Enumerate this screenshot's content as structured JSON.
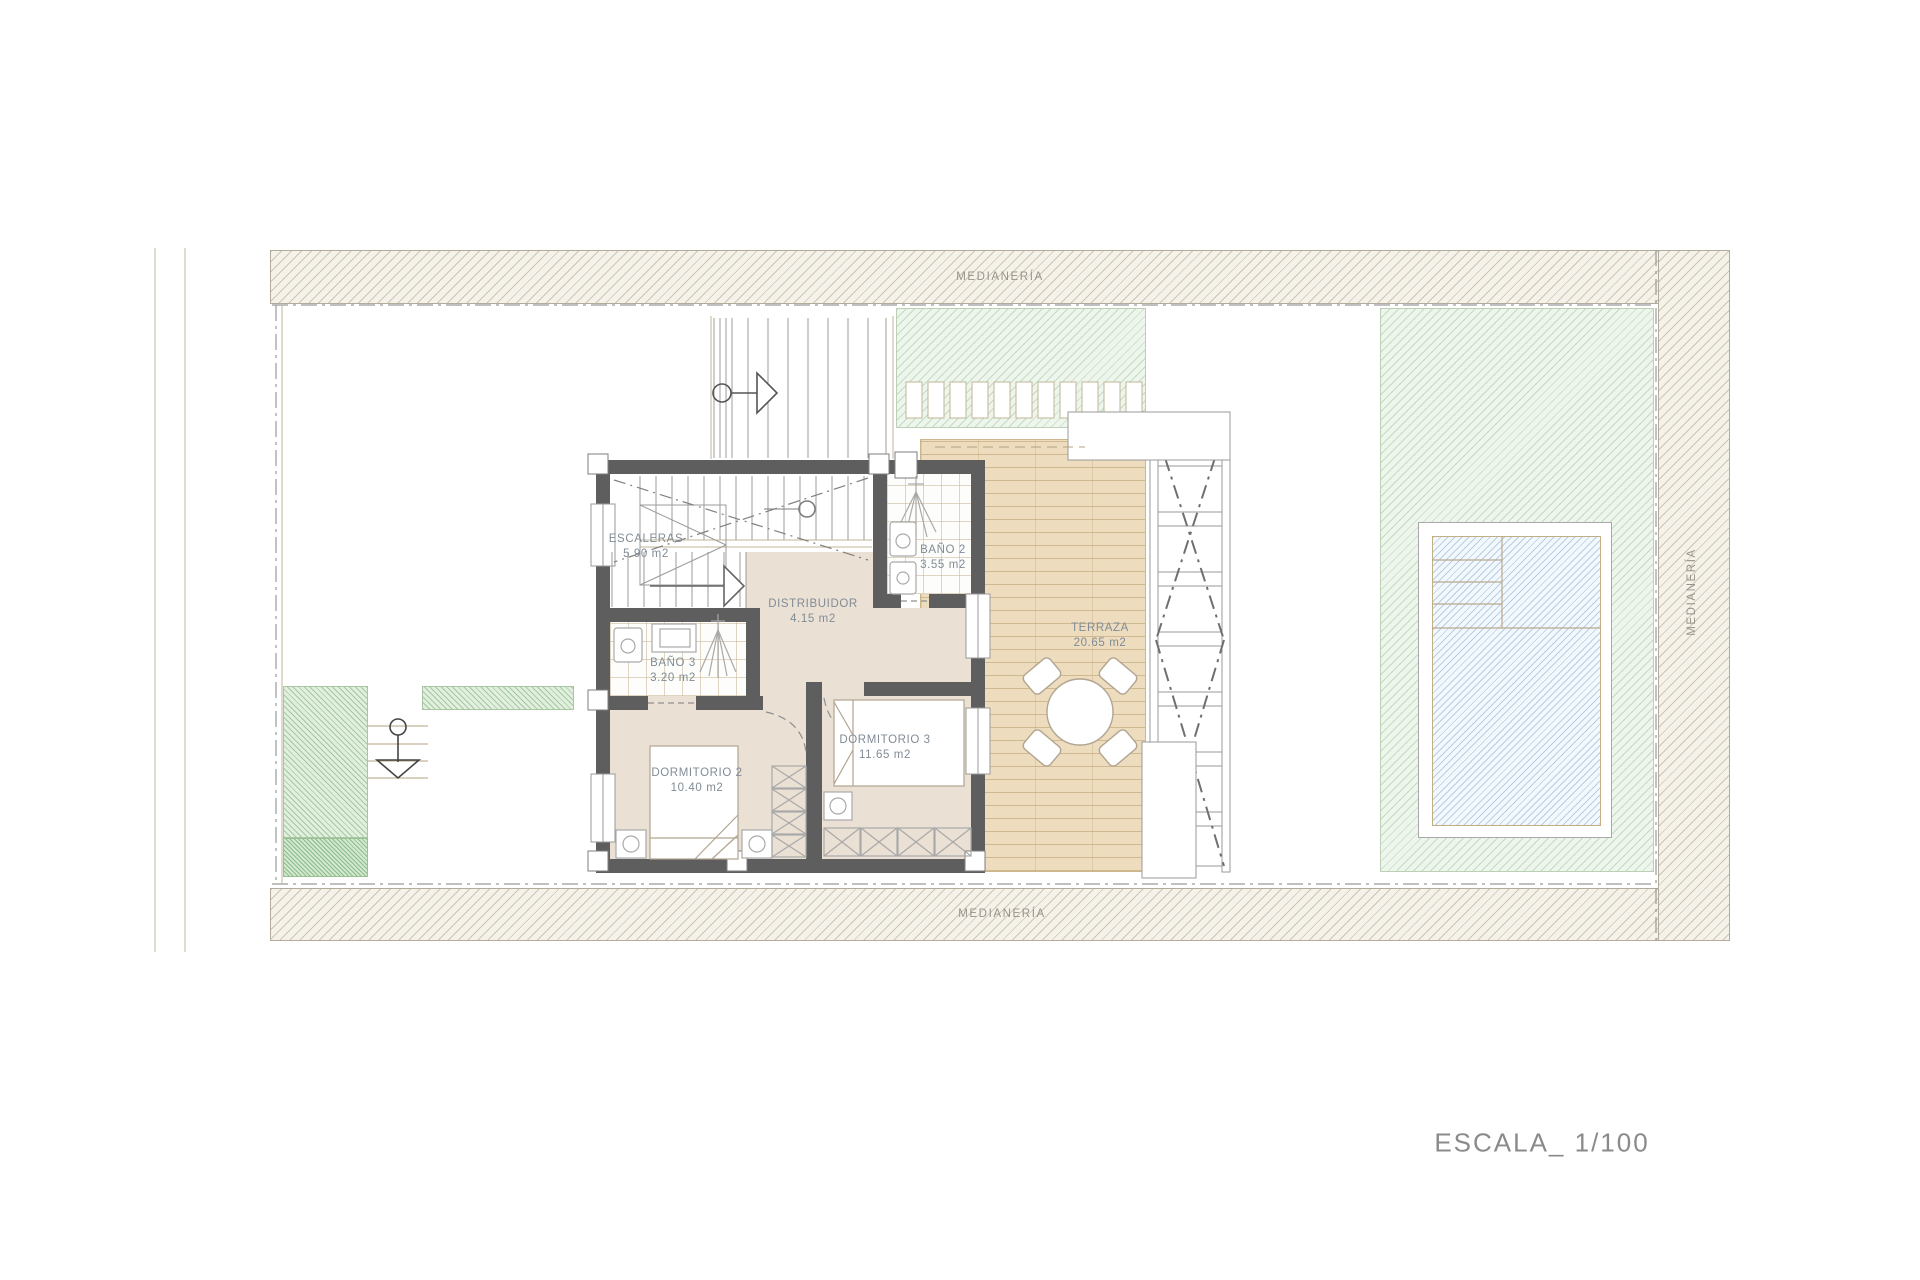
{
  "plan": {
    "scale_label": "ESCALA_ 1/100",
    "boundaries": {
      "top": "MEDIANERÍA",
      "bottom": "MEDIANERÍA",
      "right": "MEDIANERÍA"
    },
    "rooms": [
      {
        "id": "escaleras",
        "name": "ESCALERAS",
        "area": "5.90 m2"
      },
      {
        "id": "bano2",
        "name": "BAÑO 2",
        "area": "3.55 m2"
      },
      {
        "id": "bano3",
        "name": "BAÑO 3",
        "area": "3.20 m2"
      },
      {
        "id": "distribuidor",
        "name": "DISTRIBUIDOR",
        "area": "4.15 m2"
      },
      {
        "id": "dormitorio2",
        "name": "DORMITORIO 2",
        "area": "10.40 m2"
      },
      {
        "id": "dormitorio3",
        "name": "DORMITORIO 3",
        "area": "11.65 m2"
      },
      {
        "id": "terraza",
        "name": "TERRAZA",
        "area": "20.65 m2"
      }
    ],
    "colors": {
      "wall": "#5e5e5e",
      "deck": "#eddcbe",
      "interior_floor": "#eae0d4",
      "garden_hatch": "#eef5ec",
      "pool_hatch": "#f2f8fc",
      "party_wall_band": "#f5f2ea",
      "label_text": "#818c96",
      "scale_text": "#8a8a8a"
    }
  }
}
